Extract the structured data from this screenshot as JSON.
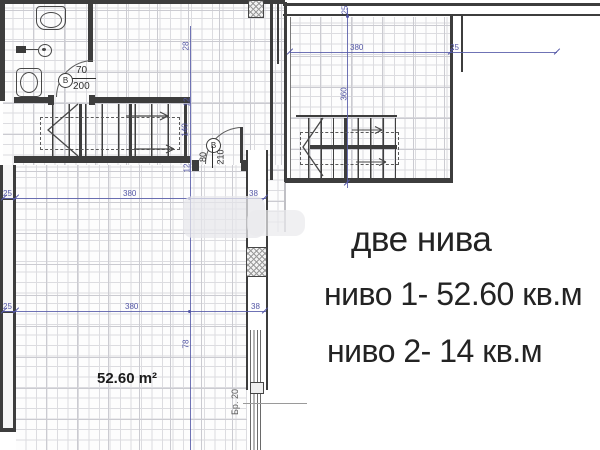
{
  "texts": {
    "two_levels": "две нива",
    "level1_area": "ниво 1- 52.60 кв.м",
    "level2_area": "ниво 2- 14 кв.м",
    "room_area": "52.60 m²",
    "stair_ref": "Бр. 20"
  },
  "doors": {
    "bathroom_door": {
      "tag": "В",
      "width": "70",
      "height": "200"
    },
    "entry_door": {
      "tag": "В",
      "width": "80",
      "height": "210"
    }
  },
  "dimensions": {
    "plan1": {
      "wall_offset": "25",
      "room_width": "380",
      "shaft_width": "38",
      "seg_28": "28",
      "seg_12": "12",
      "stair_length": "140",
      "seg_78": "78"
    },
    "plan2": {
      "room_width": "380",
      "room_depth": "360",
      "wall": "25"
    }
  },
  "colors": {
    "dimension_blue": "#5356a5",
    "wall_dark": "#3d3d3d",
    "grid_gray": "#dcdce0",
    "text_dark": "#232323"
  }
}
